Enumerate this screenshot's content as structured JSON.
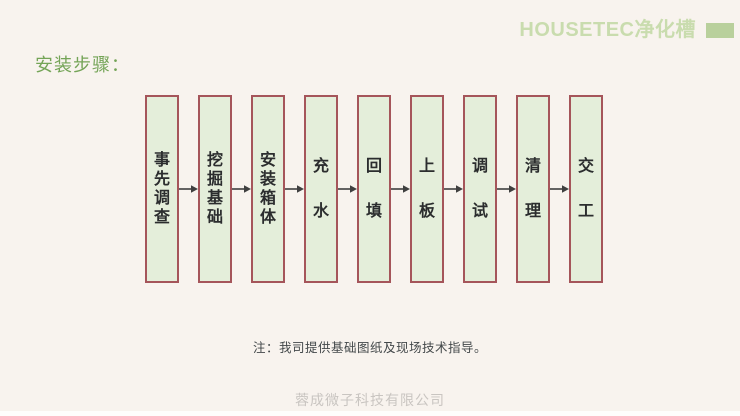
{
  "header": {
    "brand": "HOUSETEC净化槽"
  },
  "page_title": "安装步骤：",
  "flowchart": {
    "steps": [
      {
        "label": "事先调查"
      },
      {
        "label": "挖掘基础"
      },
      {
        "label": "安装箱体"
      },
      {
        "label": "充水"
      },
      {
        "label": "回填"
      },
      {
        "label": "上板"
      },
      {
        "label": "调试"
      },
      {
        "label": "清理"
      },
      {
        "label": "交工"
      }
    ]
  },
  "note": "注：我司提供基础图纸及现场技术指导。",
  "footer": "蓉成微子科技有限公司",
  "colors": {
    "background": "#f8f3ee",
    "box_fill": "#e4eeda",
    "box_border": "#a5555a",
    "title_green": "#74a457",
    "brand_green": "#c9dcae",
    "brand_rect_green": "#b9d09c",
    "arrow_gray": "#3f3f3f"
  }
}
